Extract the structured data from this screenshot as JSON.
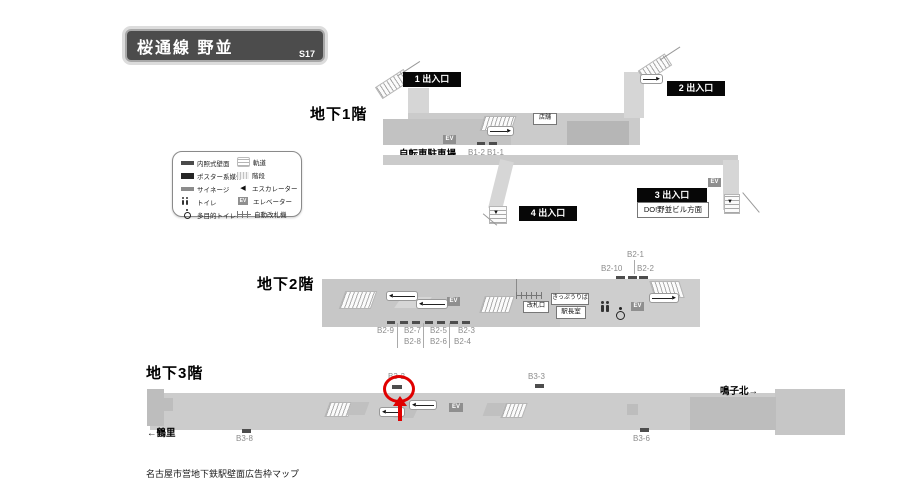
{
  "title": {
    "name": "桜通線 野並",
    "code": "S17"
  },
  "legend": {
    "left": [
      {
        "label": "内照式壁面"
      },
      {
        "label": "ポスター系媒体"
      },
      {
        "label": "サイネージ"
      },
      {
        "label": "トイレ"
      },
      {
        "label": "多目的トイレ"
      }
    ],
    "right": [
      {
        "label": "軌道"
      },
      {
        "label": "階段"
      },
      {
        "label": "エスカレーター"
      },
      {
        "label": "エレベーター"
      },
      {
        "label": "自動改札機"
      }
    ],
    "ev_icon": "EV"
  },
  "icons": {
    "left": "◀",
    "right": "▶",
    "down": "▼"
  },
  "b1": {
    "floor_label": "地下1階",
    "exit1": "1 出入口",
    "exit2": "2 出入口",
    "exit3": "3 出入口",
    "exit3_sub": "DO!野並ビル方面",
    "exit4": "4 出入口",
    "bicycle_parking": "自転車駐車場",
    "shop": "店舗",
    "ev": "EV",
    "ads": {
      "b1_2": "B1-2",
      "b1_1": "B1-1"
    }
  },
  "b2": {
    "floor_label": "地下2階",
    "ticket_window": "きっぷうりば",
    "gate_label": "改札口",
    "office": "駅長室",
    "ev": "EV",
    "ads_top": {
      "b2_1": "B2-1",
      "b2_10": "B2-10",
      "b2_2": "B2-2"
    },
    "ads_bottom": {
      "row1": [
        "B2-9",
        "B2-7",
        "B2-5",
        "B2-3"
      ],
      "row2": [
        "B2-8",
        "B2-6",
        "B2-4"
      ]
    }
  },
  "b3": {
    "floor_label": "地下3階",
    "dir_left": "←鶴里",
    "dir_right": "鳴子北→",
    "ev": "EV",
    "highlighted_ad": "B3-2",
    "ads": {
      "b3_2": "B3-2",
      "b3_3": "B3-3",
      "b3_8": "B3-8",
      "b3_6": "B3-6"
    }
  },
  "caption": "名古屋市営地下鉄駅壁面広告枠マップ"
}
